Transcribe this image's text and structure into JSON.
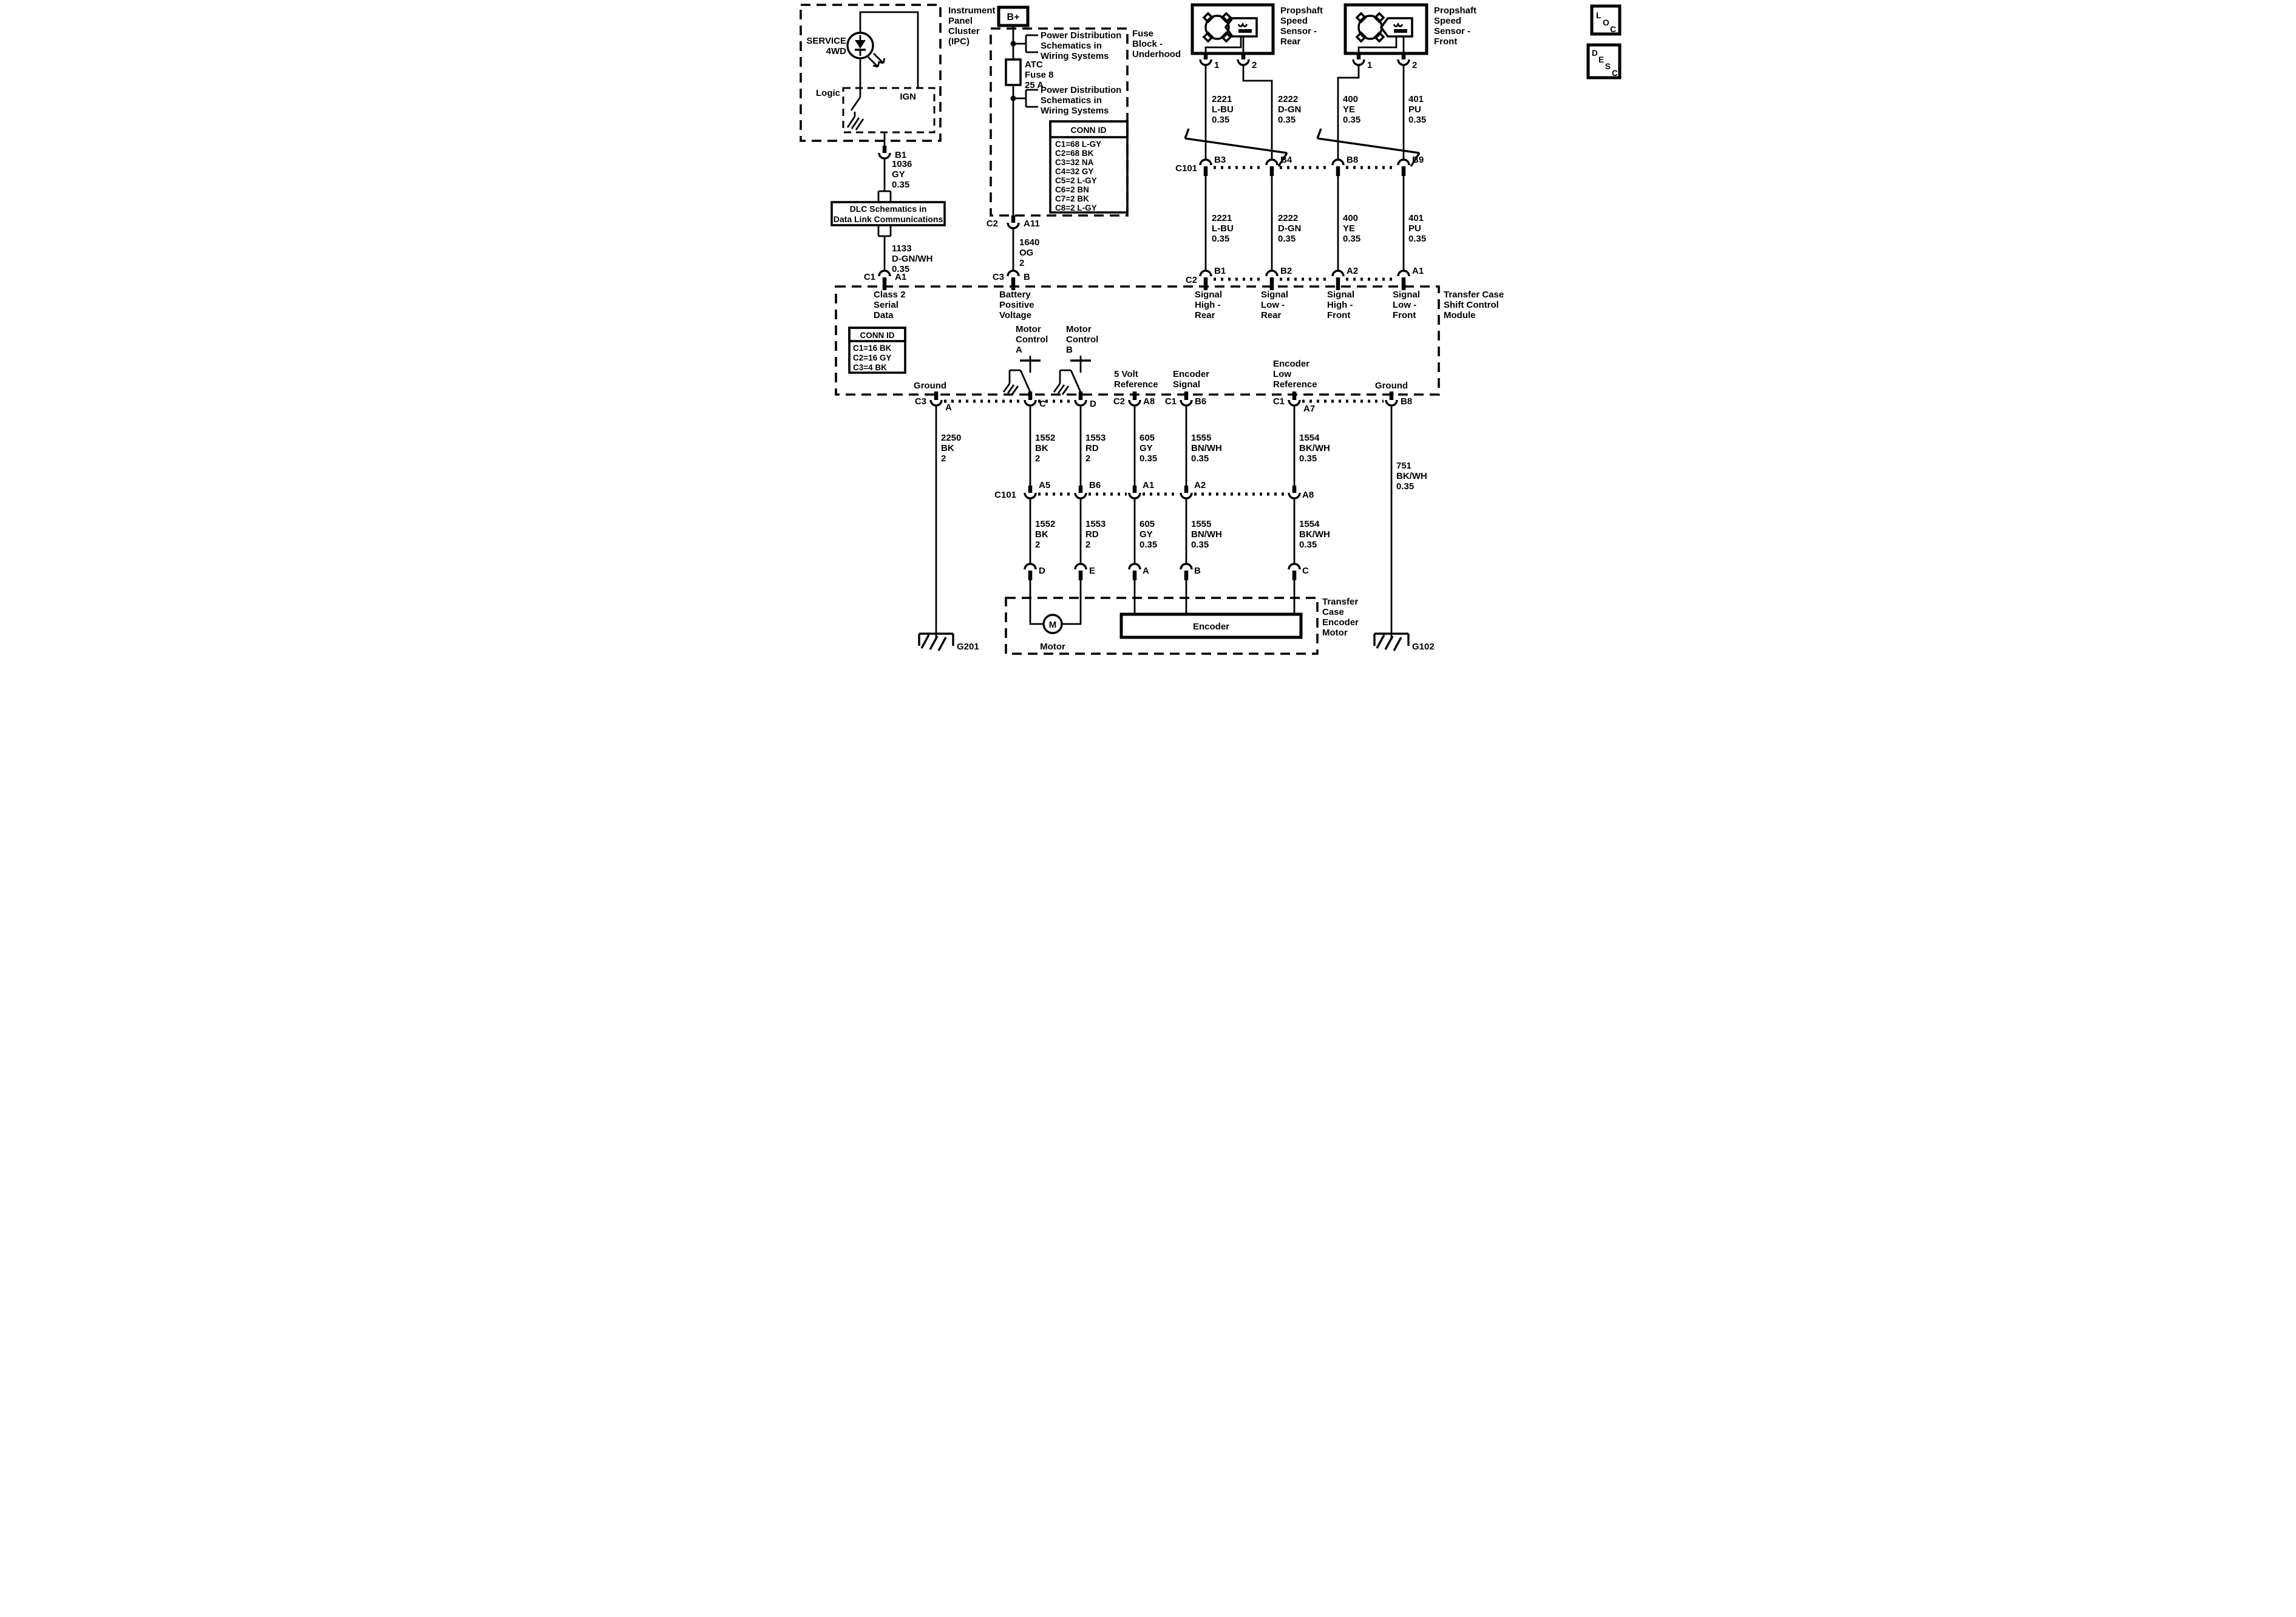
{
  "colors": {
    "ink": "#000000",
    "background": "#ffffff"
  },
  "ipc": {
    "title": [
      "Instrument",
      "Panel",
      "Cluster",
      "(IPC)"
    ],
    "lamp": [
      "SERVICE",
      "4WD"
    ],
    "logic": "Logic",
    "ign": "IGN",
    "pin_b1": "B1"
  },
  "wires": {
    "w1036": [
      "1036",
      "GY",
      "0.35"
    ],
    "w1133": [
      "1133",
      "D-GN/WH",
      "0.35"
    ],
    "w1640": [
      "1640",
      "OG",
      "2"
    ],
    "w2221": [
      "2221",
      "L-BU",
      "0.35"
    ],
    "w2222": [
      "2222",
      "D-GN",
      "0.35"
    ],
    "w400": [
      "400",
      "YE",
      "0.35"
    ],
    "w401": [
      "401",
      "PU",
      "0.35"
    ],
    "w2250": [
      "2250",
      "BK",
      "2"
    ],
    "w1552": [
      "1552",
      "BK",
      "2"
    ],
    "w1553": [
      "1553",
      "RD",
      "2"
    ],
    "w605": [
      "605",
      "GY",
      "0.35"
    ],
    "w1555": [
      "1555",
      "BN/WH",
      "0.35"
    ],
    "w1554": [
      "1554",
      "BK/WH",
      "0.35"
    ],
    "w751": [
      "751",
      "BK/WH",
      "0.35"
    ]
  },
  "dlc_box": [
    "DLC Schematics in",
    "Data Link Communications"
  ],
  "conn_c1a1": {
    "c1": "C1",
    "a1": "A1"
  },
  "class2": [
    "Class 2",
    "Serial",
    "Data"
  ],
  "bplus": "B+",
  "fuse_block": {
    "label": [
      "Fuse",
      "Block -",
      "Underhood"
    ],
    "power_dist": [
      "Power Distribution",
      "Schematics in",
      "Wiring Systems"
    ],
    "fuse": [
      "ATC",
      "Fuse 8",
      "25 A"
    ],
    "conn_id": {
      "title": "CONN ID",
      "rows": [
        "C1=68 L-GY",
        "C2=68 BK",
        "C3=32 NA",
        "C4=32 GY",
        "C5=2 L-GY",
        "C6=2 BN",
        "C7=2 BK",
        "C8=2 L-GY"
      ]
    },
    "conn_c2a11": {
      "c2": "C2",
      "a11": "A11"
    }
  },
  "conn_c3b": {
    "c3": "C3",
    "b": "B"
  },
  "battery": [
    "Battery",
    "Positive",
    "Voltage"
  ],
  "sensors": {
    "rear": [
      "Propshaft",
      "Speed",
      "Sensor -",
      "Rear"
    ],
    "front": [
      "Propshaft",
      "Speed",
      "Sensor -",
      "Front"
    ],
    "pin1": "1",
    "pin2": "2"
  },
  "c101_top": {
    "label": "C101",
    "pins": [
      "B3",
      "B4",
      "B8",
      "B9"
    ]
  },
  "module": {
    "label": [
      "Transfer Case",
      "Shift Control",
      "Module"
    ],
    "top_conn": "C2",
    "top_pins": [
      "B1",
      "B2",
      "A2",
      "A1"
    ],
    "signals": [
      [
        "Signal",
        "High -",
        "Rear"
      ],
      [
        "Signal",
        "Low -",
        "Rear"
      ],
      [
        "Signal",
        "High -",
        "Front"
      ],
      [
        "Signal",
        "Low -",
        "Front"
      ]
    ],
    "conn_id": {
      "title": "CONN ID",
      "rows": [
        "C1=16 BK",
        "C2=16 GY",
        "C3=4 BK"
      ]
    },
    "motor_a": [
      "Motor",
      "Control",
      "A"
    ],
    "motor_b": [
      "Motor",
      "Control",
      "B"
    ],
    "ground_left": "Ground",
    "ground_right": "Ground",
    "five_volt": [
      "5 Volt",
      "Reference"
    ],
    "enc_signal": [
      "Encoder",
      "Signal"
    ],
    "enc_low": [
      "Encoder",
      "Low",
      "Reference"
    ],
    "bottom": {
      "c3": "C3",
      "a": "A",
      "c": "C",
      "d": "D",
      "c2": "C2",
      "a8": "A8",
      "c1_1": "C1",
      "b6": "B6",
      "c1_2": "C1",
      "a7": "A7",
      "b8": "B8"
    }
  },
  "c101_bottom": {
    "label": "C101",
    "pins": [
      "A5",
      "B6",
      "A1",
      "A2",
      "A8"
    ]
  },
  "encoder_motor": {
    "label": [
      "Transfer",
      "Case",
      "Encoder",
      "Motor"
    ],
    "pins": [
      "D",
      "E",
      "A",
      "B",
      "C"
    ],
    "motor_m": "M",
    "motor_label": "Motor",
    "encoder_label": "Encoder"
  },
  "grounds": {
    "g201": "G201",
    "g102": "G102"
  },
  "corner": {
    "loc": [
      "L",
      "O",
      "C"
    ],
    "desc": [
      "D",
      "E",
      "S",
      "C"
    ]
  }
}
